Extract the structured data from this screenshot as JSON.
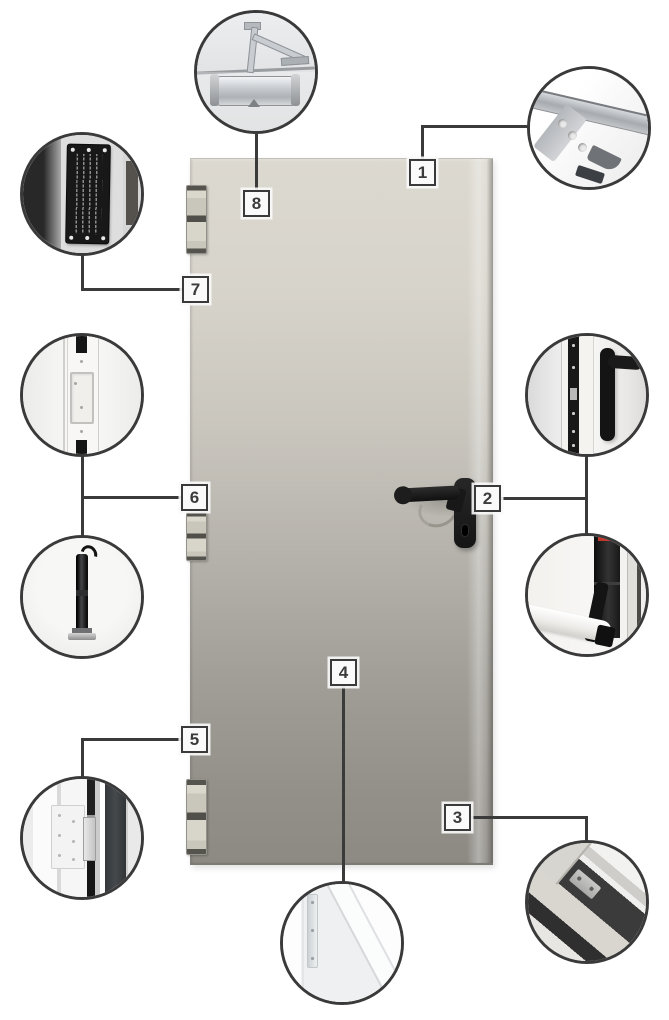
{
  "page": {
    "type": "door-components-callout-diagram",
    "background": "#ffffff"
  },
  "markers": {
    "m1": "1",
    "m2": "2",
    "m3": "3",
    "m4": "4",
    "m5": "5",
    "m6": "6",
    "m7": "7",
    "m8": "8"
  },
  "callouts": {
    "c1": "frame-anchor-bracket",
    "c2_top": "lock-edge-and-handle",
    "c2_bottom": "panic-exit-bar",
    "c3": "frame-bottom-corner",
    "c4": "door-leaf-corner-section",
    "c5": "hinge-frame-side",
    "c6_top": "edge-hinge",
    "c6_bottom": "closer-rod",
    "c7": "rating-plate",
    "c8": "overhead-door-closer"
  },
  "colors": {
    "connector_line": "#3a3a3a",
    "marker_border": "#3a3a3a",
    "marker_background": "#fafafa",
    "door_top": "#dcd9d0",
    "door_bottom": "#8d8a84",
    "handle": "#141414",
    "panic_bar_indicator": "#c0392d"
  }
}
